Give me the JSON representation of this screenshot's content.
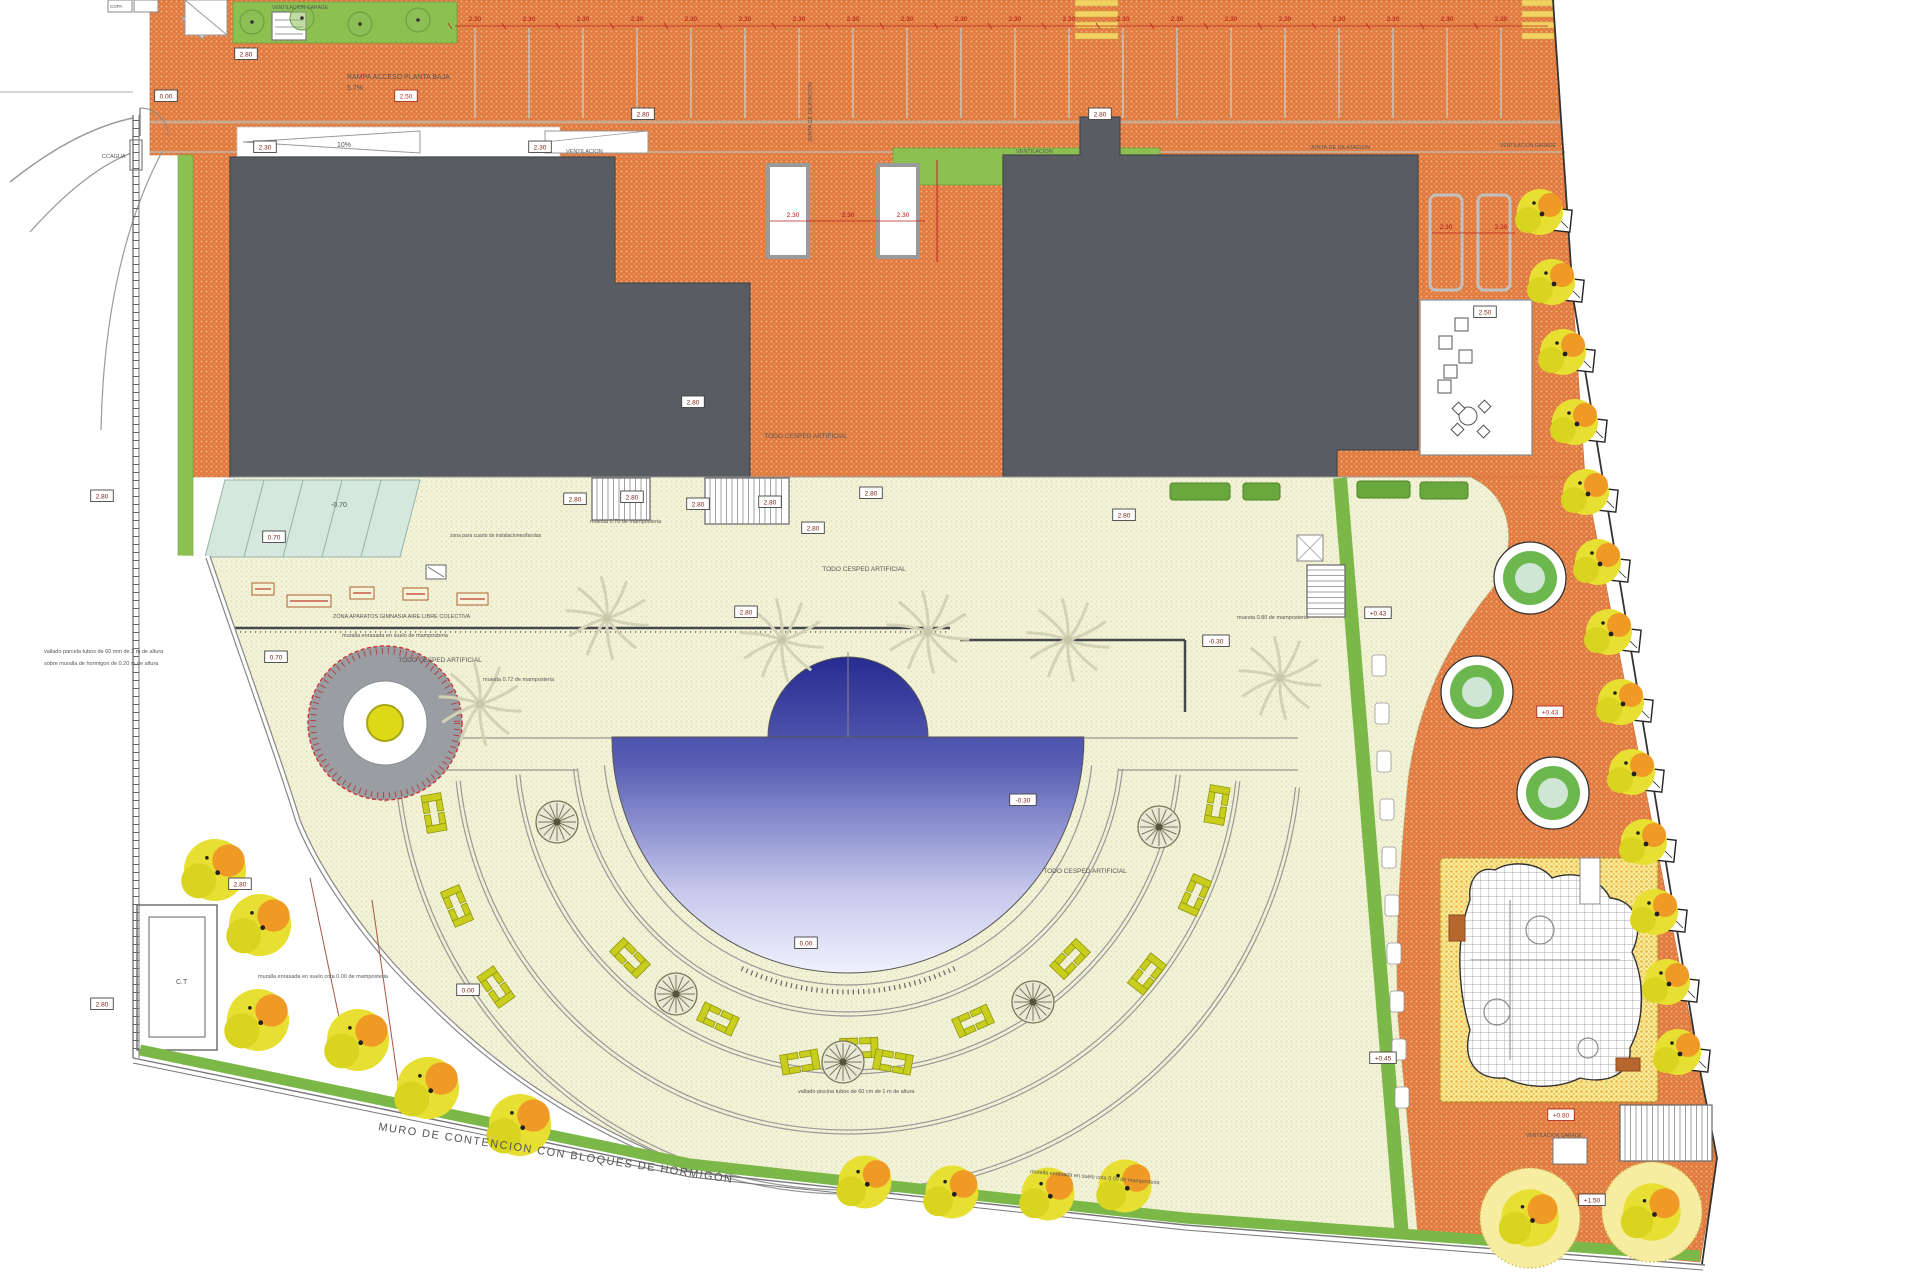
{
  "meta": {
    "type": "architectural-site-plan",
    "sheet": "landscape plan"
  },
  "colors": {
    "paving_orange": "#e0793c",
    "paving_dot": "#f2a97c",
    "building_gray": "#595d63",
    "terrace_cream": "#f4f4da",
    "terrace_dot": "#e2e2bc",
    "pool_dark": "#23288e",
    "pool_mid": "#5b60b5",
    "pool_pale": "#c6c8ec",
    "pool_white": "#f6f6ff",
    "grass_green": "#7cb848",
    "hedge_green": "#68a83c",
    "bench_yellow": "#c9ce1e",
    "tree_yellow": "#e7e032",
    "tree_orange": "#f09a26",
    "ramp_teal": "#d4e8dd",
    "red_dim": "#bb2222",
    "box_text": "#7a2218",
    "play_yellow": "#f8ec95",
    "play_dot": "#ecb24e",
    "blob_grid": "#a8a8a8",
    "boundary": "#666666",
    "wall_dark": "#45484d"
  },
  "annotations": [
    {
      "t": "VENTILACION GARAGE",
      "x": 272,
      "y": 9,
      "s": 5
    },
    {
      "t": "RAMPA ACCESO PLANTA BAJA",
      "x": 347,
      "y": 79,
      "s": 7
    },
    {
      "t": "5.7%",
      "x": 347,
      "y": 90,
      "s": 7
    },
    {
      "t": "10%",
      "x": 337,
      "y": 147,
      "s": 7
    },
    {
      "t": "VENTILACION",
      "x": 566,
      "y": 153,
      "s": 5.5
    },
    {
      "t": "VENTILACION",
      "x": 1016,
      "y": 153,
      "s": 5.5
    },
    {
      "t": "JUNTA DE DILATACION",
      "x": 812,
      "y": 142,
      "s": 5.5,
      "r": -90
    },
    {
      "t": "JUNTA DE DILATACION",
      "x": 1310,
      "y": 149,
      "s": 5.5
    },
    {
      "t": "VENTILACION GARAGE",
      "x": 1500,
      "y": 147,
      "s": 5
    },
    {
      "t": "CCAGUA",
      "x": 102,
      "y": 158,
      "s": 5.5
    },
    {
      "t": "-0.70",
      "x": 331,
      "y": 507,
      "s": 7
    },
    {
      "t": "zona para cuarto de instalaciones/farolas",
      "x": 450,
      "y": 537,
      "s": 5
    },
    {
      "t": "muesta 0.70 de mamposteria",
      "x": 590,
      "y": 523,
      "s": 5.5
    },
    {
      "t": "muesta 0.80 de mamposteria",
      "x": 1237,
      "y": 619,
      "s": 5.5
    },
    {
      "t": "muesta 0.72 de mamposteria",
      "x": 483,
      "y": 681,
      "s": 5.5
    },
    {
      "t": "muralla enrasada en suelo de mamposteria",
      "x": 342,
      "y": 637,
      "s": 5.5
    },
    {
      "t": "ZONA APARATOS GIMNASIA AIRE LIBRE COLECTIVA",
      "x": 333,
      "y": 618,
      "s": 5.5
    },
    {
      "t": "TODO CESPED ARTIFICIAL",
      "x": 806,
      "y": 438,
      "s": 6.5,
      "a": "middle"
    },
    {
      "t": "TODO CESPED ARTIFICIAL",
      "x": 864,
      "y": 571,
      "s": 6.5,
      "a": "middle"
    },
    {
      "t": "TODO CESPED ARTIFICIAL",
      "x": 440,
      "y": 662,
      "s": 6.5,
      "a": "middle"
    },
    {
      "t": "TODO CESPED ARTIFICIAL",
      "x": 1085,
      "y": 873,
      "s": 6.5,
      "a": "middle"
    },
    {
      "t": "muralla enrasada en suelo cota 0.00 de mamposteria",
      "x": 258,
      "y": 978,
      "s": 5.5
    },
    {
      "t": "muralla enrasada en suelo cota 0.00 de mamposteria",
      "x": 1030,
      "y": 1173,
      "s": 5.5,
      "r": 5
    },
    {
      "t": "vallado piscina tubos de 60 cm de 1 m de altura",
      "x": 798,
      "y": 1093,
      "s": 5.5
    },
    {
      "t": "vallado parcela tubos de 60 mm de 2 m de altura",
      "x": 44,
      "y": 653,
      "s": 5.5
    },
    {
      "t": "sobre muralla de hormigon de 0.20 m de altura",
      "x": 44,
      "y": 665,
      "s": 5.5
    },
    {
      "t": "C.T",
      "x": 176,
      "y": 984,
      "s": 7
    },
    {
      "t": "MURO DE CONTENCION  CON BLOQUES DE HORMIGÓN",
      "x": 378,
      "y": 1130,
      "s": 11,
      "r": 8.5,
      "c": "#555",
      "ls": 1.5
    },
    {
      "t": "VENTILACION GARAGE",
      "x": 1526,
      "y": 1137,
      "s": 5
    },
    {
      "t": "COPA",
      "x": 110,
      "y": 8,
      "s": 4.5
    }
  ],
  "elevation_boxes": [
    {
      "t": "2.80",
      "x": 102,
      "y": 496
    },
    {
      "t": "2.80",
      "x": 102,
      "y": 1004
    },
    {
      "t": "2.80",
      "x": 246,
      "y": 54
    },
    {
      "t": "0.00",
      "x": 166,
      "y": 96
    },
    {
      "t": "2.50",
      "x": 406,
      "y": 96,
      "red": true
    },
    {
      "t": "2.80",
      "x": 643,
      "y": 114
    },
    {
      "t": "2.80",
      "x": 1100,
      "y": 114
    },
    {
      "t": "2.30",
      "x": 265,
      "y": 147
    },
    {
      "t": "2.30",
      "x": 540,
      "y": 147
    },
    {
      "t": "0.70",
      "x": 274,
      "y": 537
    },
    {
      "t": "0.70",
      "x": 276,
      "y": 657
    },
    {
      "t": "2.80",
      "x": 575,
      "y": 499
    },
    {
      "t": "2.80",
      "x": 632,
      "y": 497
    },
    {
      "t": "2.80",
      "x": 698,
      "y": 504
    },
    {
      "t": "2.80",
      "x": 770,
      "y": 502
    },
    {
      "t": "2.80",
      "x": 813,
      "y": 528
    },
    {
      "t": "2.80",
      "x": 693,
      "y": 402
    },
    {
      "t": "2.80",
      "x": 871,
      "y": 493
    },
    {
      "t": "2.80",
      "x": 746,
      "y": 612
    },
    {
      "t": "2.80",
      "x": 1124,
      "y": 515
    },
    {
      "t": "+0.43",
      "x": 1378,
      "y": 613
    },
    {
      "t": "+0.43",
      "x": 1550,
      "y": 712,
      "red": true
    },
    {
      "t": "-0.30",
      "x": 1216,
      "y": 641
    },
    {
      "t": "-0.30",
      "x": 1023,
      "y": 800
    },
    {
      "t": "+0.80",
      "x": 1561,
      "y": 1115,
      "red": true
    },
    {
      "t": "+1.50",
      "x": 1592,
      "y": 1200
    },
    {
      "t": "0.00",
      "x": 806,
      "y": 943
    },
    {
      "t": "+0.45",
      "x": 1383,
      "y": 1058
    },
    {
      "t": "2.80",
      "x": 240,
      "y": 884
    },
    {
      "t": "0.00",
      "x": 468,
      "y": 990
    },
    {
      "t": "2.50",
      "x": 1485,
      "y": 312
    }
  ],
  "dim_top": {
    "label": "2.30",
    "y": 21,
    "x0": 475,
    "step": 54,
    "count": 20,
    "line_y": 26,
    "x_start": 455,
    "x_end": 1548
  },
  "dim_mid": {
    "label": "2.30",
    "y": 217,
    "xs": [
      793,
      848,
      903
    ],
    "line_y": 221,
    "x_start": 770,
    "x_end": 925
  },
  "dim_right": {
    "label": "2.30",
    "y": 229,
    "xs": [
      1446,
      1501
    ],
    "line_y": 233,
    "x_start": 1432,
    "x_end": 1515
  },
  "parking_lines": {
    "x0": 475,
    "step": 54,
    "count": 20,
    "y1": 28,
    "y2": 118
  },
  "arcs": {
    "cx": 848,
    "cy": 740,
    "rings": [
      245,
      272,
      276,
      330,
      334,
      390,
      394,
      450,
      454
    ],
    "a0": 174,
    "a1": 6,
    "fence": {
      "r": 252,
      "a0": 65,
      "a1": 115
    }
  },
  "pool": {
    "cx": 848,
    "cy": 737,
    "r": 236,
    "dome_r": 80
  },
  "benches": [
    [
      1070,
      959,
      134
    ],
    [
      973,
      1021,
      156
    ],
    [
      859,
      1048,
      178
    ],
    [
      718,
      1019,
      205
    ],
    [
      630,
      958,
      225
    ],
    [
      434,
      813,
      260
    ],
    [
      457,
      906,
      247
    ],
    [
      496,
      987,
      235
    ],
    [
      1217,
      805,
      100
    ],
    [
      1195,
      895,
      114
    ],
    [
      1147,
      974,
      128
    ],
    [
      800,
      1062,
      170
    ],
    [
      893,
      1062,
      190
    ]
  ],
  "palms_faint": [
    [
      607,
      618
    ],
    [
      782,
      640
    ],
    [
      928,
      632
    ],
    [
      1068,
      640
    ],
    [
      1280,
      678
    ],
    [
      480,
      704
    ]
  ],
  "palms_dark": [
    [
      676,
      994
    ],
    [
      1033,
      1002
    ],
    [
      557,
      822
    ],
    [
      1159,
      827
    ],
    [
      843,
      1062
    ]
  ],
  "circles_green": [
    [
      1530,
      578
    ],
    [
      1477,
      692
    ],
    [
      1553,
      793
    ]
  ],
  "stones": [
    [
      1372,
      655
    ],
    [
      1375,
      703
    ],
    [
      1377,
      751
    ],
    [
      1380,
      799
    ],
    [
      1382,
      847
    ],
    [
      1385,
      895
    ],
    [
      1387,
      943
    ],
    [
      1390,
      991
    ],
    [
      1392,
      1039
    ],
    [
      1395,
      1087
    ]
  ],
  "equipment": [
    [
      252,
      583,
      22
    ],
    [
      287,
      595,
      44
    ],
    [
      350,
      587,
      24
    ],
    [
      403,
      588,
      25
    ],
    [
      457,
      593,
      31
    ]
  ],
  "hedges": [
    [
      1170,
      483,
      60
    ],
    [
      1243,
      483,
      37
    ],
    [
      1357,
      481,
      53
    ],
    [
      1420,
      482,
      48
    ]
  ],
  "stairs": [
    {
      "x": 592,
      "y": 478,
      "w": 58,
      "h": 42,
      "dir": "v"
    },
    {
      "x": 705,
      "y": 478,
      "w": 84,
      "h": 46,
      "dir": "v"
    },
    {
      "x": 1307,
      "y": 565,
      "w": 38,
      "h": 52,
      "dir": "h"
    },
    {
      "x": 1620,
      "y": 1105,
      "w": 92,
      "h": 56,
      "dir": "v"
    }
  ],
  "trees_wedge": [
    [
      215,
      870
    ],
    [
      260,
      925
    ],
    [
      258,
      1020
    ],
    [
      358,
      1040
    ],
    [
      428,
      1088
    ],
    [
      520,
      1125
    ]
  ],
  "trees_bottom": [
    [
      865,
      1182
    ],
    [
      952,
      1192
    ],
    [
      1048,
      1194
    ],
    [
      1125,
      1186
    ]
  ],
  "trees_dotted": [
    [
      1530,
      1218
    ],
    [
      1652,
      1212
    ]
  ],
  "trees_top_strip": [
    [
      252,
      22
    ],
    [
      302,
      18
    ],
    [
      360,
      24
    ],
    [
      418,
      20
    ]
  ],
  "trees_right_edge": [
    [
      1560,
      220
    ],
    [
      1572,
      290
    ],
    [
      1583,
      360
    ],
    [
      1595,
      430
    ],
    [
      1606,
      500
    ],
    [
      1618,
      570
    ],
    [
      1629,
      640
    ],
    [
      1641,
      710
    ],
    [
      1652,
      780
    ],
    [
      1664,
      850
    ],
    [
      1675,
      920
    ],
    [
      1687,
      990
    ],
    [
      1698,
      1060
    ]
  ],
  "patio": {
    "x": 1420,
    "y": 300,
    "w": 112,
    "h": 155,
    "chairs": [
      [
        1455,
        318
      ],
      [
        1439,
        336
      ],
      [
        1459,
        350
      ],
      [
        1444,
        365
      ],
      [
        1438,
        380
      ]
    ],
    "table": [
      1468,
      416
    ]
  },
  "court_vents": [
    [
      768,
      165
    ],
    [
      878,
      165
    ]
  ],
  "right_bays": [
    [
      1430,
      195
    ],
    [
      1478,
      195
    ]
  ],
  "crossings": [
    [
      1075,
      0,
      43
    ],
    [
      1522,
      0,
      32
    ]
  ],
  "target_circle": {
    "x": 385,
    "y": 723,
    "r_out": 77,
    "r_mid": 42,
    "r_in": 18
  }
}
